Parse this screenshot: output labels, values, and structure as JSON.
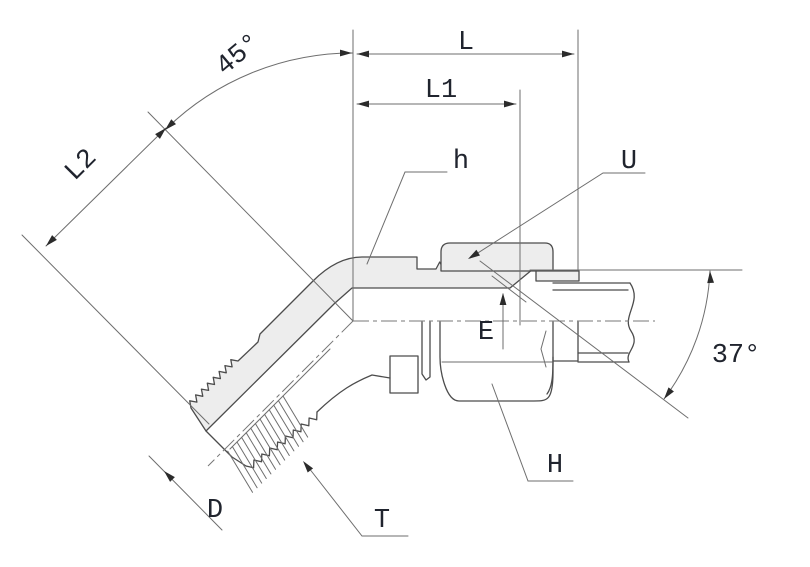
{
  "drawing": {
    "type": "technical-drawing",
    "subject": "45-degree flare tube fitting elbow, half-section view with tube and nut",
    "labels": {
      "bend_angle": "45°",
      "flare_angle": "37°",
      "overall_length": "L",
      "length_l1": "L1",
      "length_l2": "L2",
      "body_hex": "h",
      "sleeve": "U",
      "tube_end": "E",
      "thread_diameter": "D",
      "thread": "T",
      "nut_hex": "H"
    },
    "colors": {
      "outline": "#4c4c4c",
      "thin_line": "#6e6e6e",
      "section_fill": "#ededed",
      "label_text": "#20242e",
      "background": "#ffffff"
    }
  }
}
